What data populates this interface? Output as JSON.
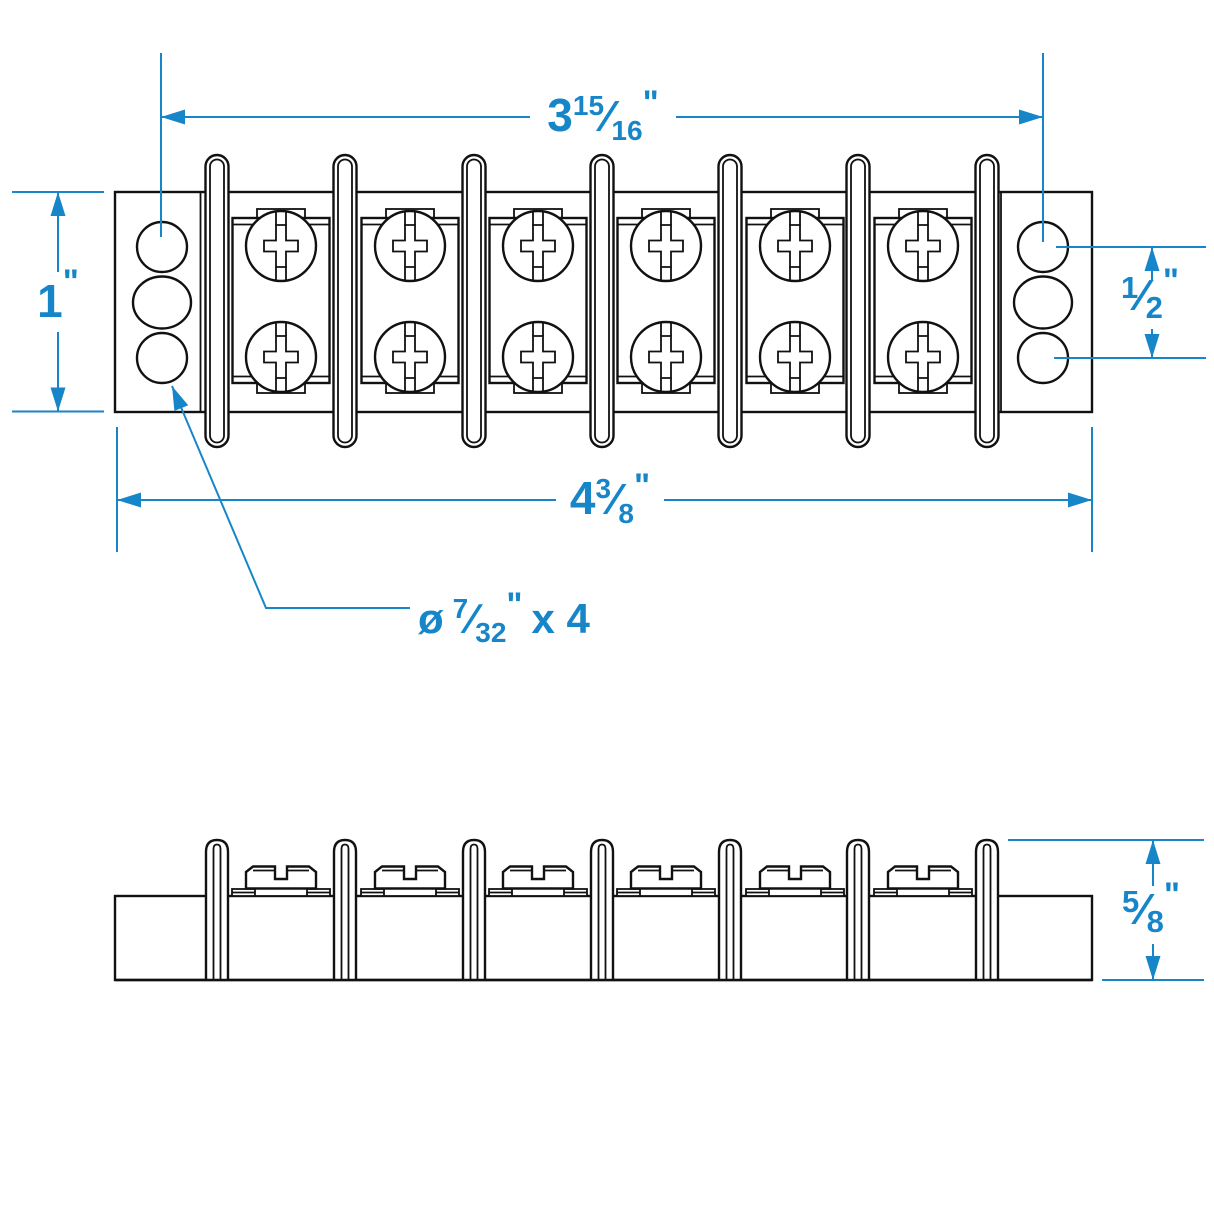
{
  "colors": {
    "accent": "#1786c9",
    "line": "#111111"
  },
  "dimensions": {
    "top_width": {
      "whole": "3",
      "numerator": "15",
      "denominator": "16",
      "unit": "\""
    },
    "body_height": {
      "whole": "1",
      "unit": "\""
    },
    "hole_spacing": {
      "numerator": "1",
      "denominator": "2",
      "unit": "\""
    },
    "overall_width": {
      "whole": "4",
      "numerator": "3",
      "denominator": "8",
      "unit": "\""
    },
    "side_height": {
      "numerator": "5",
      "denominator": "8",
      "unit": "\""
    },
    "hole_callout": {
      "symbol": "ø",
      "numerator": "7",
      "denominator": "32",
      "unit": "\"",
      "count": "x 4"
    },
    "fraction_slash": "⁄"
  }
}
